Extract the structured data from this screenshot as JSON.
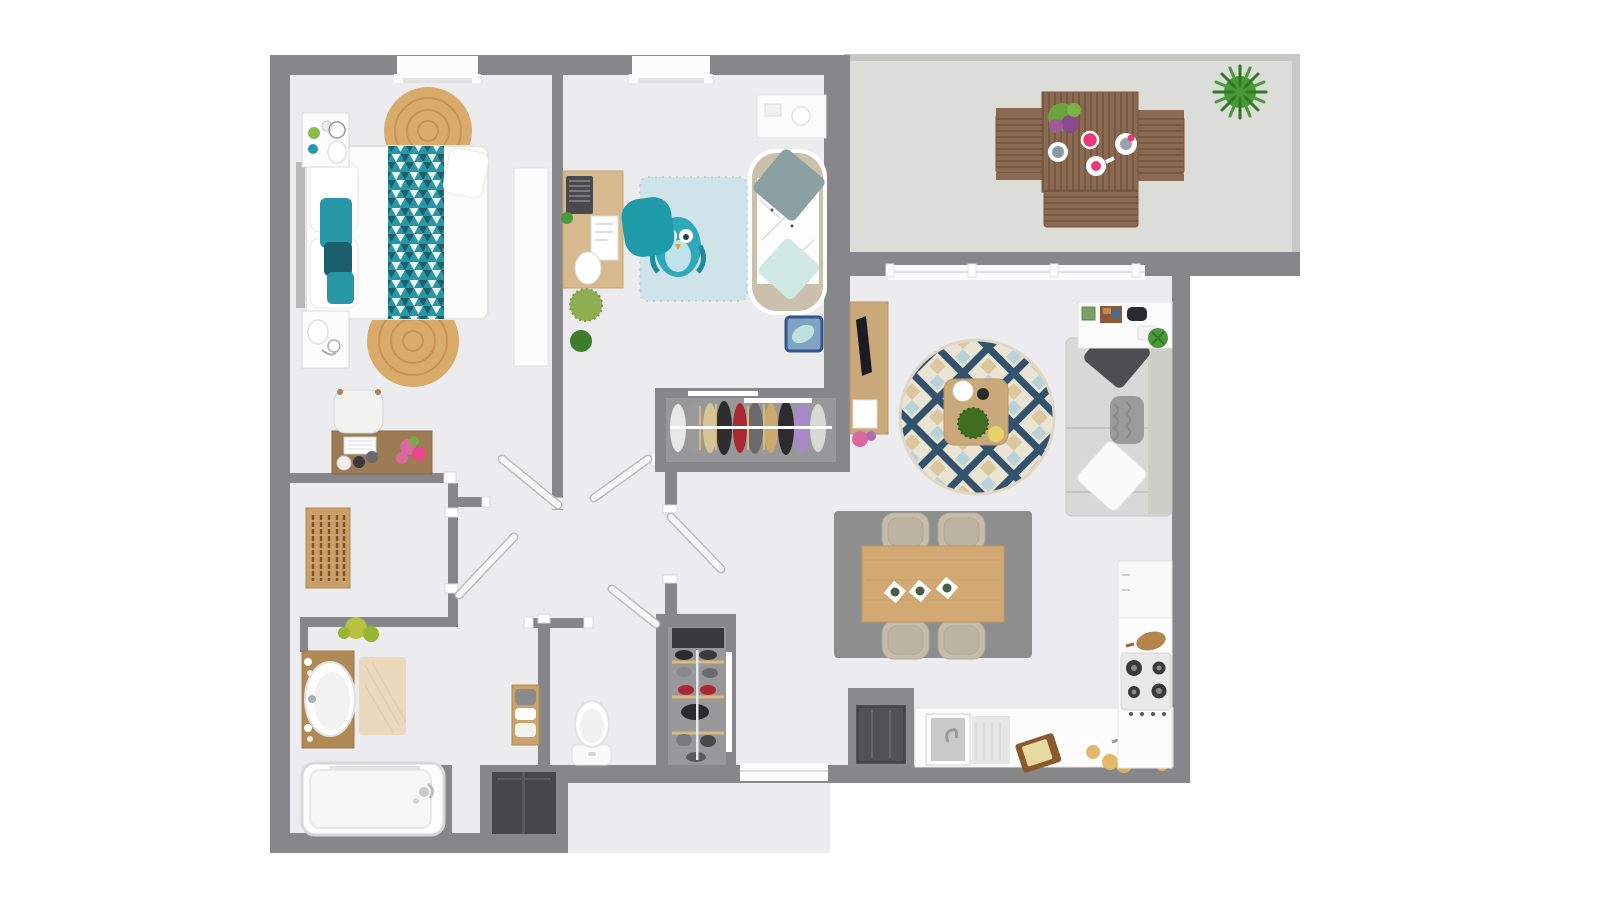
{
  "scene": {
    "kind": "floor-plan-3d-render",
    "view": "top-down",
    "width_px": 1600,
    "height_px": 900
  },
  "palette": {
    "bg": "#ffffff",
    "wall": "#87878a",
    "floor": "#ececee",
    "terrace": "#dcdcd8",
    "railing": "#c7c7c5",
    "white": "#fcfcfc",
    "off": "#f4f4f3",
    "frame": "#e2e2e2",
    "leaf": "#f7f7f7",
    "leaf_edge": "#bdbdbd",
    "entry_frame": "#8a8a8d",
    "entry_door": "#525255",
    "niche": "#47474a",
    "closet_floor": "#98989b",
    "shelf_dark": "#3a3a3d",
    "wood_light": "#d2a873",
    "wood_mid": "#c9a87a",
    "wood_desk": "#9c7b55",
    "wood_vanity": "#b08a54",
    "wood_shelf": "#c9a36a",
    "jute": "#d9ab6b",
    "jute_ring": "#c6934f",
    "teal": "#2797a5",
    "teal_dark": "#1b5f6d",
    "teal_chair": "#1f9aa8",
    "kids_rug": "#cfe4ea",
    "owl": "#2fa8ba",
    "daybed_frame": "#cbc0ae",
    "mint": "#cfe8e2",
    "sage": "#8ba1a1",
    "basket_blue": "#35548c",
    "basket_fill": "#7fa3c2",
    "rug_base": "#eae4d4",
    "rug_navy": "#33526e",
    "rug_blue": "#b7d2d8",
    "rug_tan": "#dbc79e",
    "dining_rug": "#8e8e8e",
    "chair_beige": "#c6bcab",
    "sofa": "#d8d8d6",
    "sofa_line": "#c3c3c1",
    "pillow_dark": "#4e4e50",
    "knit": "#9b9b99",
    "terr_wood": "#8a6a52",
    "terr_wood_dark": "#76593f",
    "green": "#4a9a3a",
    "green_dark": "#3f7d2c",
    "green_yellow": "#b4c43e",
    "moss": "#3e6e1e",
    "pink": "#e83a7a",
    "flower_pink": "#d96a9e",
    "mat": "#ead9bc",
    "steel": "#c9c9c7",
    "red": "#a82834",
    "purple": "#a88ac8",
    "black": "#2b2b2e",
    "tan_food": "#e0b96a",
    "headboard": "#b8b8b6"
  },
  "rooms": [
    {
      "id": "bedroom-1",
      "furniture": [
        "double-bed",
        "teal-triangle-runner",
        "pillows",
        "round-jute-rug-top",
        "round-jute-rug-bottom",
        "nightstand-left-top",
        "nightstand-left-bottom",
        "table-lamps",
        "white-wardrobe",
        "desk",
        "desk-chair",
        "flower-vase",
        "window"
      ]
    },
    {
      "id": "bedroom-2-kids",
      "furniture": [
        "study-desk",
        "laptop",
        "papers",
        "desk-lamp",
        "teal-chair",
        "owl-polka-rug",
        "daybed-with-pillows",
        "blue-basket",
        "side-table",
        "plants",
        "built-in-wardrobe-with-clothes",
        "window"
      ]
    },
    {
      "id": "terrace",
      "furniture": [
        "outdoor-dining-table",
        "outdoor-bench",
        "outdoor-armchair-left",
        "outdoor-armchair-right",
        "pink-tableware",
        "centerpiece-plant",
        "fern-plant",
        "sliding-glass-door"
      ]
    },
    {
      "id": "living-room",
      "furniture": [
        "tv-stand",
        "tv",
        "round-geometric-rug",
        "coffee-table",
        "moss-bowl",
        "sofa",
        "throw-pillows",
        "console-shelf",
        "game-controller",
        "houseplant"
      ]
    },
    {
      "id": "dining-area",
      "furniture": [
        "gray-rug",
        "dining-table",
        "four-beige-chairs",
        "place-settings"
      ]
    },
    {
      "id": "kitchen",
      "furniture": [
        "l-shaped-counter",
        "sink",
        "faucet",
        "gas-hob",
        "fridge-cabinet",
        "cutting-board",
        "pastries-plates"
      ]
    },
    {
      "id": "bathroom",
      "furniture": [
        "wood-vanity",
        "oval-sink",
        "beige-mat",
        "bathtub",
        "towel-shelf",
        "wall-plant",
        "technical-niche"
      ]
    },
    {
      "id": "wc",
      "furniture": [
        "toilet"
      ]
    },
    {
      "id": "hallway",
      "furniture": [
        "wooden-drying-rack",
        "shoe-closet",
        "entry-door",
        "interior-doors",
        "window"
      ]
    }
  ]
}
